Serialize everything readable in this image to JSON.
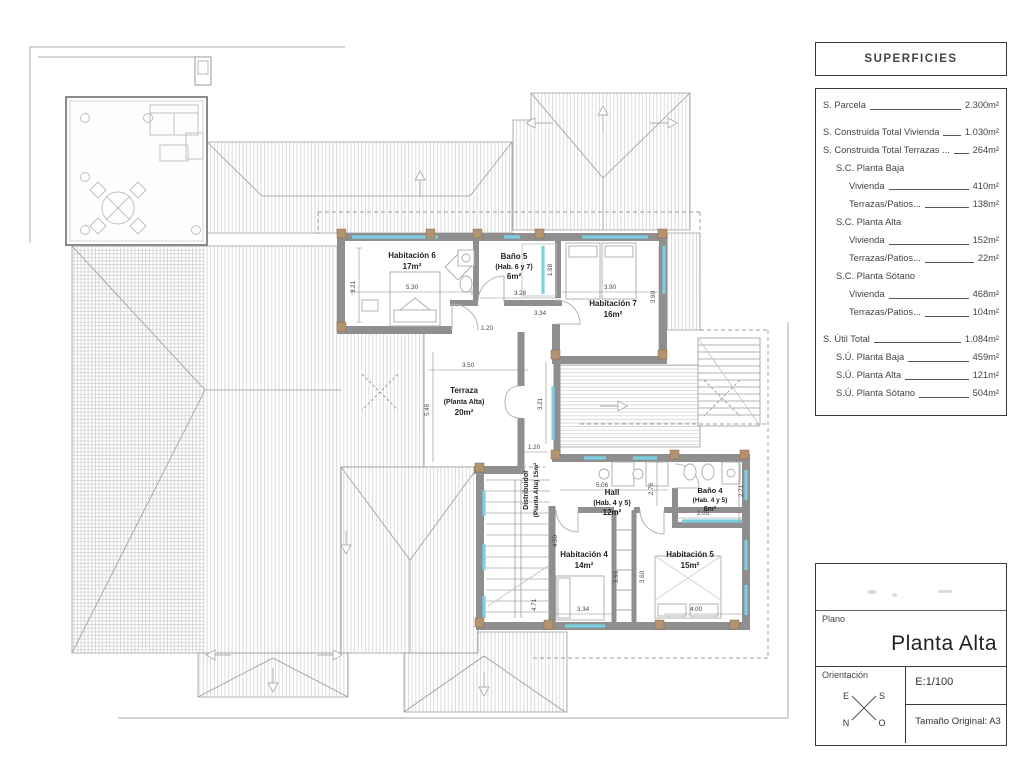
{
  "superficies": {
    "title": "SUPERFICIES",
    "rows": [
      {
        "label": "S. Parcela",
        "value": "2.300m²"
      },
      {
        "label": "S. Construida Total Vivienda",
        "value": "1.030m²"
      },
      {
        "label": "S. Construida Total Terrazas ...",
        "value": "264m²"
      },
      {
        "label": "S.C. Planta Baja",
        "value": ""
      },
      {
        "label": "Vivienda",
        "value": "410m²"
      },
      {
        "label": "Terrazas/Patios...",
        "value": "138m²"
      },
      {
        "label": "S.C. Planta Alta",
        "value": ""
      },
      {
        "label": "Vivienda",
        "value": "152m²"
      },
      {
        "label": "Terrazas/Patios...",
        "value": "22m²"
      },
      {
        "label": "S.C. Planta Sótano",
        "value": ""
      },
      {
        "label": "Vivienda",
        "value": "468m²"
      },
      {
        "label": "Terrazas/Patios...",
        "value": "104m²"
      },
      {
        "label": "S. Útil Total",
        "value": "1.084m²"
      },
      {
        "label": "S.Ú. Planta Baja",
        "value": "459m²"
      },
      {
        "label": "S.Ú. Planta Alta",
        "value": "121m²"
      },
      {
        "label": "S.Ú. Planta Sótano",
        "value": "504m²"
      }
    ]
  },
  "titleblock": {
    "plano_label": "Plano",
    "title": "Planta Alta",
    "orientation_label": "Orientación",
    "compass": {
      "e": "E",
      "s": "S",
      "n": "N",
      "o": "O"
    },
    "scale": "E:1/100",
    "size": "Tamaño Original: A3"
  },
  "plan": {
    "rooms": {
      "hab6": {
        "name": "Habitación 6",
        "area": "17m²"
      },
      "bano5": {
        "name": "Baño 5",
        "sub": "(Hab. 6 y 7)",
        "area": "6m²"
      },
      "hab7": {
        "name": "Habitación 7",
        "area": "16m²"
      },
      "terraza": {
        "name": "Terraza",
        "sub": "(Planta Alta)",
        "area": "20m²"
      },
      "distribuidor": {
        "name": "Distribuidor",
        "sub": "(Planta Alta) 15m²"
      },
      "hall": {
        "name": "Hall",
        "sub": "(Hab. 4 y 5)",
        "area": "12m²"
      },
      "bano4": {
        "name": "Baño 4",
        "sub": "(Hab. 4 y 5)",
        "area": "6m²"
      },
      "hab4": {
        "name": "Habitación 4",
        "area": "14m²"
      },
      "hab5": {
        "name": "Habitación 5",
        "area": "15m²"
      }
    },
    "dims": {
      "d01": "5.30",
      "d02": "3.21",
      "d03": "3.28",
      "d04": "1.98",
      "d05": "3.34",
      "d06": "1.20",
      "d07": "3.90",
      "d08": "3.90",
      "d09": "3.50",
      "d10": "5.46",
      "d11": "3.21",
      "d12": "1.20",
      "d13": "5.06",
      "d14": "2.76",
      "d15": "2.71",
      "d16": "2.05",
      "d17": "4.50",
      "d18": "4.71",
      "d19": "3.34",
      "d20": "3.60",
      "d21": "3.60",
      "d22": "4.00"
    }
  }
}
